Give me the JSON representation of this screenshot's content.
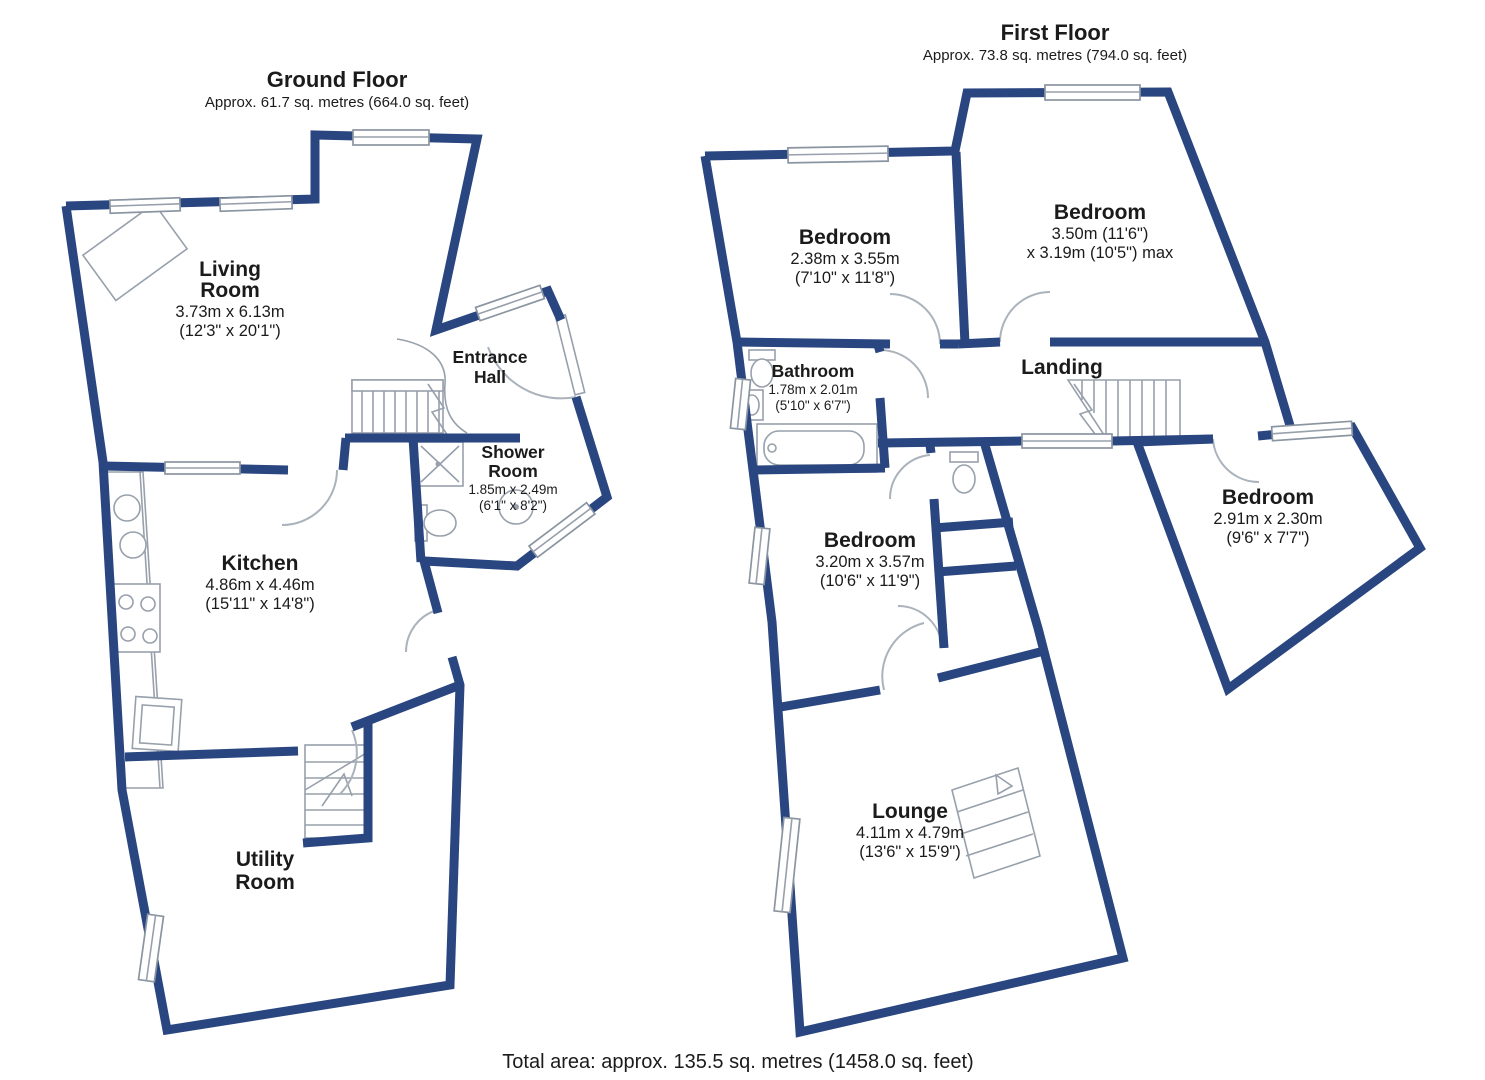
{
  "colors": {
    "wall": "#2a4680"
  },
  "footer": {
    "total_area": "Total area: approx. 135.5 sq. metres (1458.0 sq. feet)"
  },
  "ground_floor": {
    "title": "Ground Floor",
    "subtitle": "Approx. 61.7 sq. metres (664.0 sq. feet)",
    "rooms": {
      "living_room": {
        "line1": "Living",
        "line2": "Room",
        "metric": "3.73m x 6.13m",
        "imperial": "(12'3\" x 20'1\")"
      },
      "entrance_hall": {
        "line1": "Entrance",
        "line2": "Hall"
      },
      "shower_room": {
        "line1": "Shower",
        "line2": "Room",
        "metric": "1.85m x 2.49m",
        "imperial": "(6'1\" x 8'2\")"
      },
      "kitchen": {
        "line1": "Kitchen",
        "metric": "4.86m x 4.46m",
        "imperial": "(15'11\" x 14'8\")"
      },
      "utility_room": {
        "line1": "Utility",
        "line2": "Room"
      }
    }
  },
  "first_floor": {
    "title": "First Floor",
    "subtitle": "Approx. 73.8 sq. metres (794.0 sq. feet)",
    "rooms": {
      "bedroom1": {
        "line1": "Bedroom",
        "metric": "2.38m x 3.55m",
        "imperial": "(7'10\" x 11'8\")"
      },
      "bedroom2": {
        "line1": "Bedroom",
        "metric": "3.50m (11'6\")",
        "imperial": "x 3.19m (10'5\") max"
      },
      "bathroom": {
        "line1": "Bathroom",
        "metric": "1.78m x 2.01m",
        "imperial": "(5'10\" x 6'7\")"
      },
      "landing": {
        "line1": "Landing"
      },
      "bedroom3": {
        "line1": "Bedroom",
        "metric": "3.20m x 3.57m",
        "imperial": "(10'6\" x 11'9\")"
      },
      "bedroom4": {
        "line1": "Bedroom",
        "metric": "2.91m x 2.30m",
        "imperial": "(9'6\" x 7'7\")"
      },
      "lounge": {
        "line1": "Lounge",
        "metric": "4.11m x 4.79m",
        "imperial": "(13'6\" x 15'9\")"
      }
    }
  }
}
